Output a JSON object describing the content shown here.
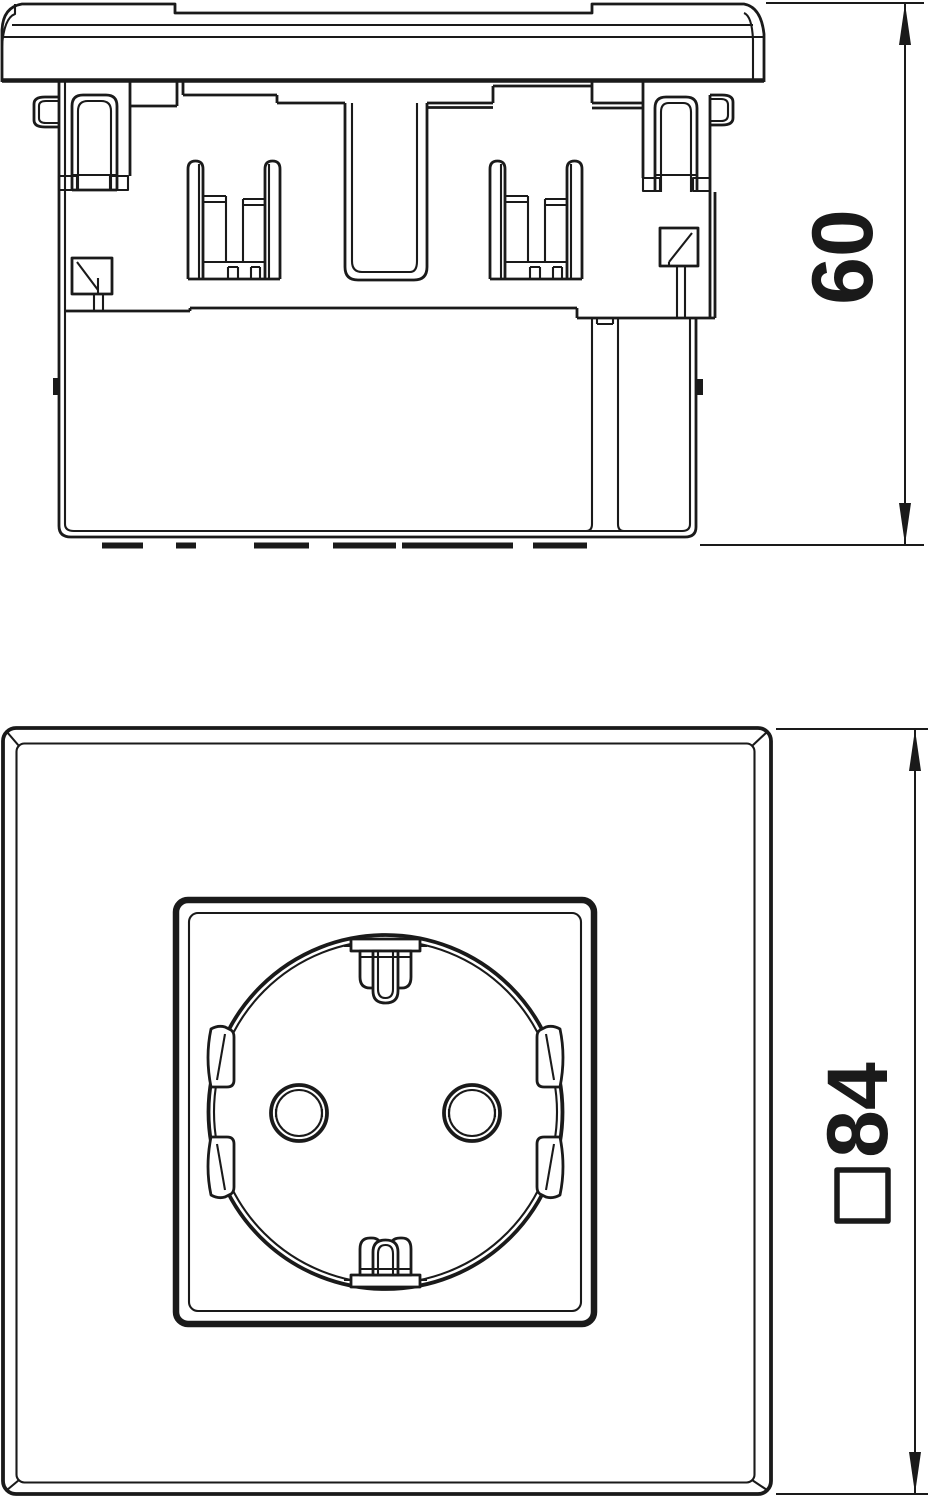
{
  "page": {
    "background": "#ffffff"
  },
  "drawing": {
    "line_color": "#1a1a1a",
    "views": {
      "side": {
        "name": "side-elevation-of-socket-insert",
        "dimension": {
          "value": "60",
          "orientation": "vertical",
          "reading": "bottom-up"
        }
      },
      "front": {
        "name": "front-elevation-of-schuko-socket",
        "dimension": {
          "value": "84",
          "symbol": "□",
          "orientation": "vertical",
          "reading": "bottom-up"
        }
      }
    }
  }
}
